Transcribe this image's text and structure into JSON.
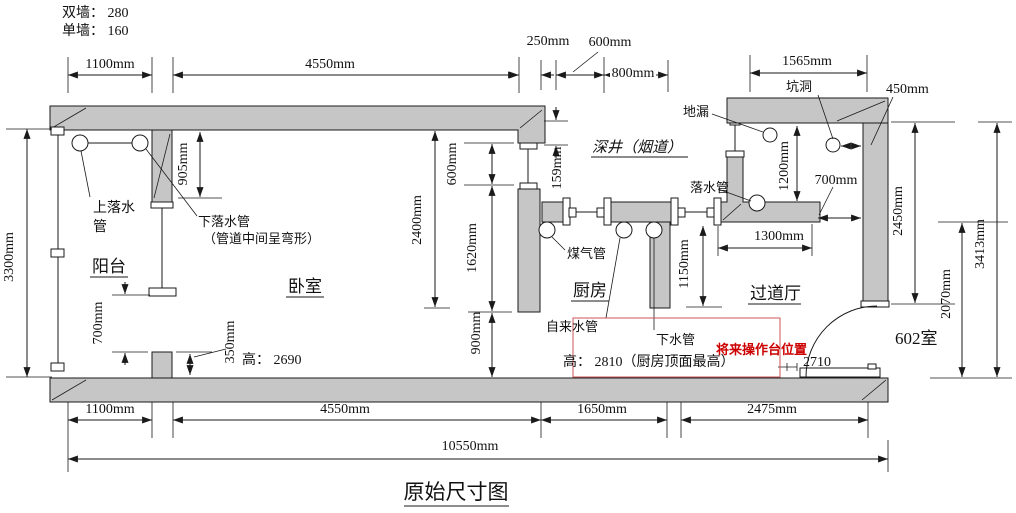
{
  "notes": {
    "double_wall": "双墙： 280",
    "single_wall": "单墙： 160"
  },
  "title": "原始尺寸图",
  "rooms": {
    "balcony": "阳台",
    "bedroom": "卧室",
    "kitchen": "厨房",
    "hallway": "过道厅",
    "shaft": "深井（烟道）",
    "room602": "602室"
  },
  "pipes": {
    "upper_drain_line1": "上落水",
    "upper_drain_line2": "管",
    "lower_drain_line1": "下落水管",
    "lower_drain_line2": "（管道中间呈弯形）",
    "gas": "煤气管",
    "tap_water": "自来水管",
    "sewer": "下水管",
    "drain": "落水管",
    "floor_drain": "地漏",
    "pit": "坑洞"
  },
  "heights": {
    "bedroom": "高： 2690",
    "kitchen": "高： 2810（厨房顶面最高）"
  },
  "annotations": {
    "future_counter": "将来操作台位置",
    "door_width": "2710"
  },
  "dims_top": {
    "w1100": "1100mm",
    "w4550": "4550mm",
    "w250": "250mm",
    "w600": "600mm",
    "w800": "800mm",
    "w1565": "1565mm",
    "w450": "450mm"
  },
  "dims_left": {
    "h3300": "3300mm",
    "h905": "905mm",
    "h700": "700mm",
    "h350": "350mm"
  },
  "dims_mid": {
    "h2400": "2400mm",
    "h600": "600mm",
    "h1620": "1620mm",
    "h900": "900mm",
    "h159": "159mm",
    "h1150": "1150mm"
  },
  "dims_right": {
    "h1200": "1200mm",
    "w700": "700mm",
    "w1300": "1300mm",
    "h2450": "2450mm",
    "h2070": "2070mm",
    "h3413": "3413mm"
  },
  "dims_bottom": {
    "w1100": "1100mm",
    "w4550": "4550mm",
    "w1650": "1650mm",
    "w2475": "2475mm",
    "w10550": "10550mm"
  },
  "colors": {
    "wall_fill": "#c6c6c6",
    "line": "#1a1a1a",
    "red_text": "#cc0000",
    "red_box": "#cc5555"
  }
}
